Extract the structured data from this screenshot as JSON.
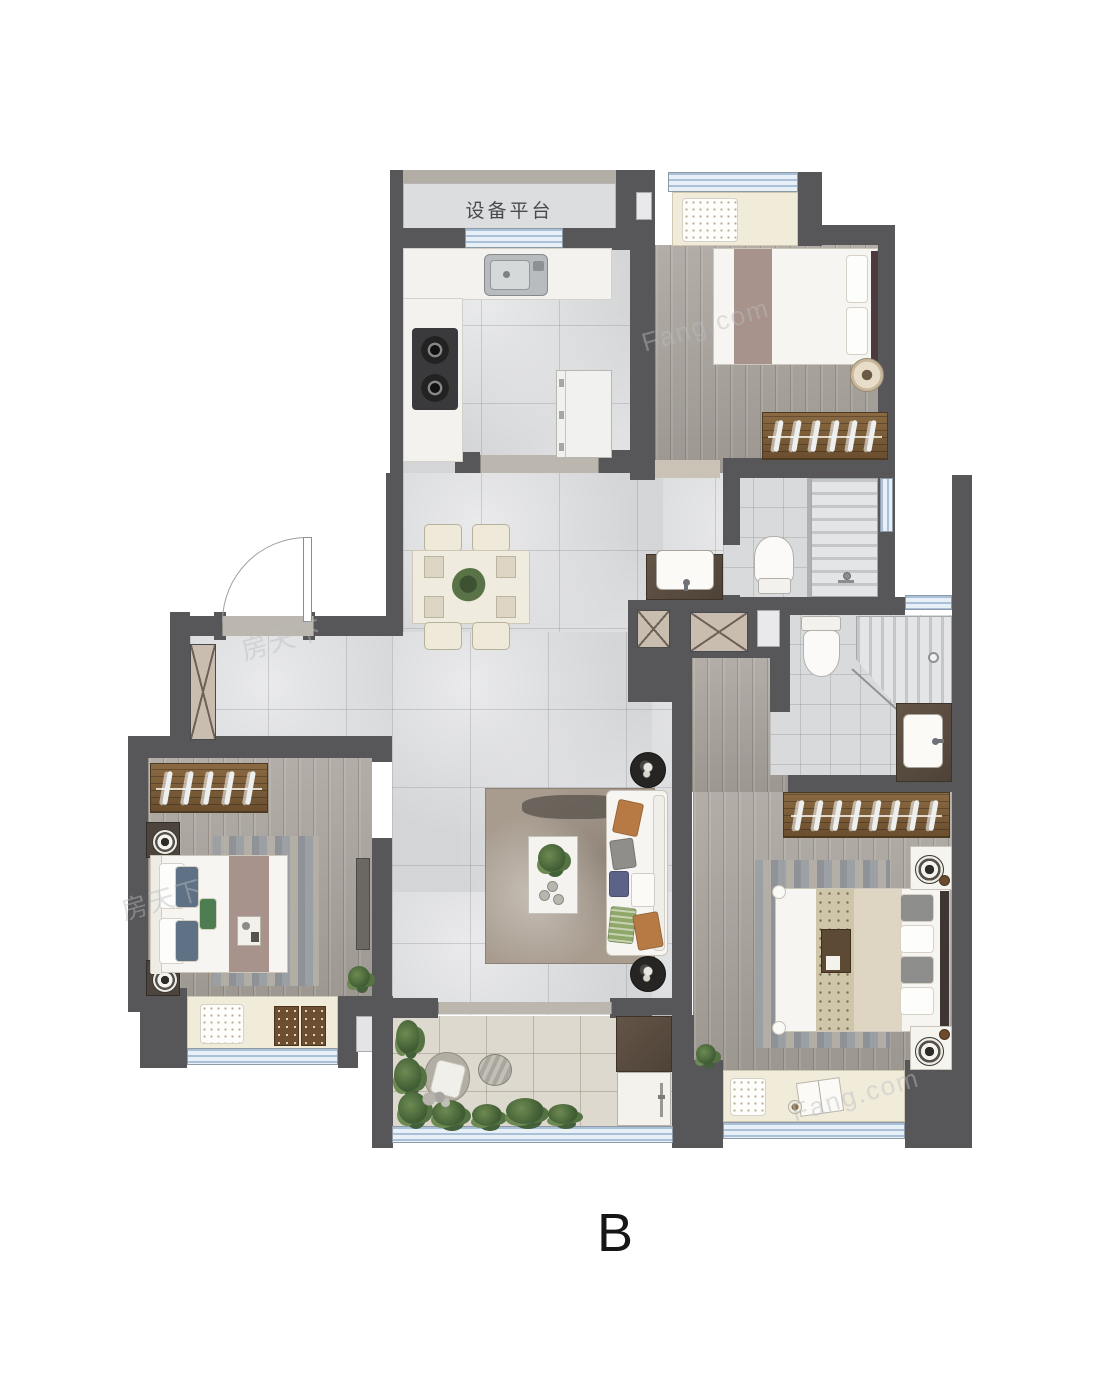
{
  "labels": {
    "equipment_platform": "设备平台",
    "unit": "B"
  },
  "watermarks": {
    "w1": "Fang.com",
    "w2": "房天下",
    "w3": "Fang.com",
    "w4": "房天下"
  },
  "colors": {
    "wall_dark": "#57575a",
    "wall_beige": "#b3aea5",
    "window_blue": "#cfdeed",
    "floor_marble": "#d4d5d7",
    "floor_wood": "#a8a29b",
    "floor_tile": "#d9dadb",
    "floor_balcony": "#ded9cf",
    "bay_seat_beige": "#f1ebda",
    "wardrobe_brown": "#7a5c38",
    "counter_brown": "#5a4c3f",
    "accent_mauve": "#a8928c",
    "sofa_white": "#f6f5f1",
    "cushion_orange": "#b87a44",
    "cushion_blue": "#5c6288",
    "cushion_green": "#8fa768",
    "label_text": "#4a4a4c",
    "unit_label_text": "#161616"
  },
  "icons": [
    "door-swing-icon",
    "kitchen-sink-icon",
    "stove-icon",
    "fridge-icon",
    "dining-table-icon",
    "chair-icon",
    "plant-icon",
    "shoe-cabinet-icon",
    "shaft-x-icon",
    "toilet-icon",
    "shower-icon",
    "washbasin-icon",
    "bed-icon",
    "wardrobe-hangers-icon",
    "nightstand-lamp-icon",
    "sofa-icon",
    "coffee-table-icon",
    "side-table-icon",
    "rug-icon",
    "lounge-chair-icon",
    "stone-table-icon",
    "washing-machine-icon",
    "bay-window-seat-icon",
    "window-icon"
  ]
}
